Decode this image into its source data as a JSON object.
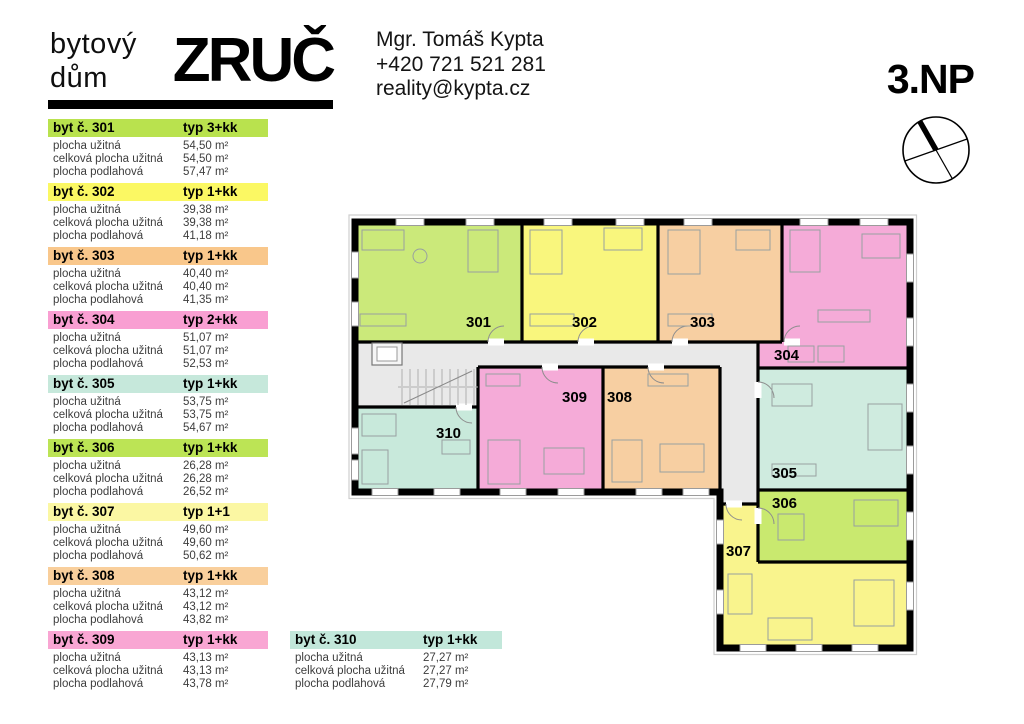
{
  "brand": {
    "line1": "bytový",
    "line2": "dům",
    "name": "ZRUČ"
  },
  "contact": {
    "name": "Mgr. Tomáš Kypta",
    "phone": "+420 721 521 281",
    "email": "reality@kypta.cz"
  },
  "floor_label": "3.NP",
  "row_labels": [
    "plocha užitná",
    "celková plocha užitná",
    "plocha podlahová"
  ],
  "apartments": [
    {
      "id": "301",
      "title": "byt č. 301",
      "typ": "typ 3+kk",
      "header_color": "#b9e24e",
      "plan_color": "#cbe97a",
      "areas": [
        "54,50 m²",
        "54,50 m²",
        "57,47 m²"
      ]
    },
    {
      "id": "302",
      "title": "byt č. 302",
      "typ": "typ 1+kk",
      "header_color": "#fbf863",
      "plan_color": "#f9f67d",
      "areas": [
        "39,38 m²",
        "39,38 m²",
        "41,18 m²"
      ]
    },
    {
      "id": "303",
      "title": "byt č. 303",
      "typ": "typ 1+kk",
      "header_color": "#f9c78b",
      "plan_color": "#f7cfa2",
      "areas": [
        "40,40 m²",
        "40,40 m²",
        "41,35 m²"
      ]
    },
    {
      "id": "304",
      "title": "byt č. 304",
      "typ": "typ 2+kk",
      "header_color": "#f99fd2",
      "plan_color": "#f5abd8",
      "areas": [
        "51,07 m²",
        "51,07 m²",
        "52,53 m²"
      ]
    },
    {
      "id": "305",
      "title": "byt č. 305",
      "typ": "typ 1+kk",
      "header_color": "#c6e8db",
      "plan_color": "#cfebdf",
      "areas": [
        "53,75 m²",
        "53,75 m²",
        "54,67 m²"
      ]
    },
    {
      "id": "306",
      "title": "byt č. 306",
      "typ": "typ 1+kk",
      "header_color": "#bce455",
      "plan_color": "#c9e96f",
      "areas": [
        "26,28 m²",
        "26,28 m²",
        "26,52 m²"
      ]
    },
    {
      "id": "307",
      "title": "byt č. 307",
      "typ": "typ 1+1",
      "header_color": "#fbf7a3",
      "plan_color": "#f9f48d",
      "areas": [
        "49,60 m²",
        "49,60 m²",
        "50,62 m²"
      ]
    },
    {
      "id": "308",
      "title": "byt č. 308",
      "typ": "typ 1+kk",
      "header_color": "#f9cf9c",
      "plan_color": "#f7cfa2",
      "areas": [
        "43,12 m²",
        "43,12 m²",
        "43,82 m²"
      ]
    },
    {
      "id": "309",
      "title": "byt č. 309",
      "typ": "typ 1+kk",
      "header_color": "#f9a6d3",
      "plan_color": "#f5abd8",
      "areas": [
        "43,13 m²",
        "43,13 m²",
        "43,78 m²"
      ]
    },
    {
      "id": "310",
      "title": "byt č. 310",
      "typ": "typ 1+kk",
      "header_color": "#c2e7da",
      "plan_color": "#c8e9db",
      "areas": [
        "27,27 m²",
        "27,27 m²",
        "27,79 m²"
      ]
    }
  ]
}
